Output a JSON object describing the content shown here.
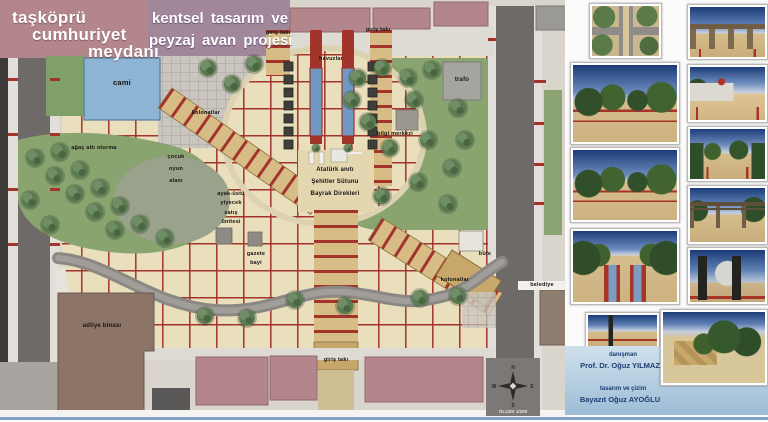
{
  "colors": {
    "accent_red": "#a2342c",
    "plaza_tan": "#e9dfbc",
    "walkway_tan": "#d7bd85",
    "park_green": "#8aa470",
    "pool_blue": "#7099c2",
    "road_gray": "#6e6a67",
    "cami_blue": "#8db4d2",
    "credits_navy": "#1c3e74",
    "credits_bg": "#bcd3e4"
  },
  "header": {
    "title_lines": [
      "taşköprü",
      "cumhuriyet",
      "meydanı"
    ],
    "subtitle_lines": [
      "kentsel tasarım ve",
      "peyzaj avan projesi"
    ]
  },
  "plan": {
    "labels": {
      "cami": "cami",
      "giris_taki_nw": "giriş takı",
      "giris_taki_ne": "giriş takı",
      "giris_taki_s": "giriş takı",
      "havuzlar": "havuzlar",
      "trafo": "trafo",
      "bilgi_merkezi": "bilgi merkezi",
      "kolonatlar_nw": "kolonatlar",
      "kolonatlar_se": "kolonatlar",
      "agac_alti_oturma": "ağaç altı oturma",
      "cocuk_oyun_alani": "çocuk\noyun\nalanı",
      "ayak_ustu": "ayak-üstü\nyiyecek\nsatış\nünitesi",
      "gazete_bayi": "gazete\nbayi",
      "monument": "Atatürk anıtı\nŞehitler Sütunu\nBayrak Direkleri",
      "bufe": "büfe",
      "belediye": "belediye",
      "adliye": "adliye binası"
    },
    "compass": {
      "n": "N",
      "e": "E",
      "s": "S",
      "w": "W",
      "scale": "ÖLÇEK 1/200"
    }
  },
  "renders": {
    "items": [
      "aerial-plan-view",
      "park-walkway-perspective",
      "plaza-trees-perspective",
      "pools-axis-perspective",
      "entry-pole-view",
      "colonnade-axis-view",
      "flag-plaza-view",
      "tree-lined-path-view",
      "pergola-frame-view",
      "dark-columns-plaza-view",
      "terraced-garden-view"
    ]
  },
  "credits": {
    "advisor_label": "danışman",
    "advisor_name": "Prof. Dr. Oğuz YILMAZ",
    "designer_label": "tasarım ve çizim",
    "designer_name": "Bayazıt Oğuz AYOĞLU"
  }
}
